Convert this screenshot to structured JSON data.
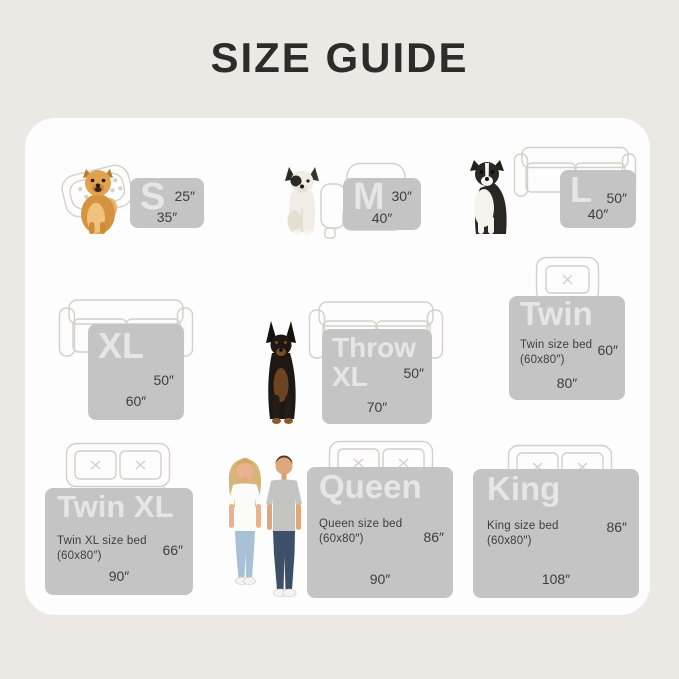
{
  "title": "SIZE GUIDE",
  "colors": {
    "bg": "#ece8e3",
    "card": "#fdfdfd",
    "swatch": "#c4c4c4",
    "letter": "rgba(255,255,255,0.58)",
    "text": "#3e3e3e",
    "outline": "#d4cfc8",
    "title": "#2e2c2a"
  },
  "sizes": [
    {
      "label": "S",
      "right": "25″",
      "bottom": "35″",
      "subject": "pomeranian-dog",
      "furniture": "pet-bed"
    },
    {
      "label": "M",
      "right": "30″",
      "bottom": "40″",
      "subject": "french-bulldog",
      "furniture": "armchair"
    },
    {
      "label": "L",
      "right": "50″",
      "bottom": "40″",
      "subject": "border-collie-dog",
      "furniture": "loveseat-sofa"
    },
    {
      "label": "XL",
      "right": "50″",
      "bottom": "60″",
      "subject": "",
      "furniture": "sofa"
    },
    {
      "label": "Throw XL",
      "right": "50″",
      "bottom": "70″",
      "subject": "doberman-dog",
      "furniture": "sofa"
    },
    {
      "label": "Twin",
      "note": "Twin size bed (60x80″)",
      "right": "60″",
      "bottom": "80″",
      "subject": "",
      "furniture": "twin-bed"
    },
    {
      "label": "Twin XL",
      "note": "Twin XL size bed (60x80″)",
      "right": "66″",
      "bottom": "90″",
      "subject": "",
      "furniture": "double-bed"
    },
    {
      "label": "Queen",
      "note": "Queen size bed (60x80″)",
      "right": "86″",
      "bottom": "90″",
      "subject": "couple",
      "furniture": "double-bed"
    },
    {
      "label": "King",
      "note": "King size bed (60x80″)",
      "right": "86″",
      "bottom": "108″",
      "subject": "",
      "furniture": "double-bed"
    }
  ]
}
